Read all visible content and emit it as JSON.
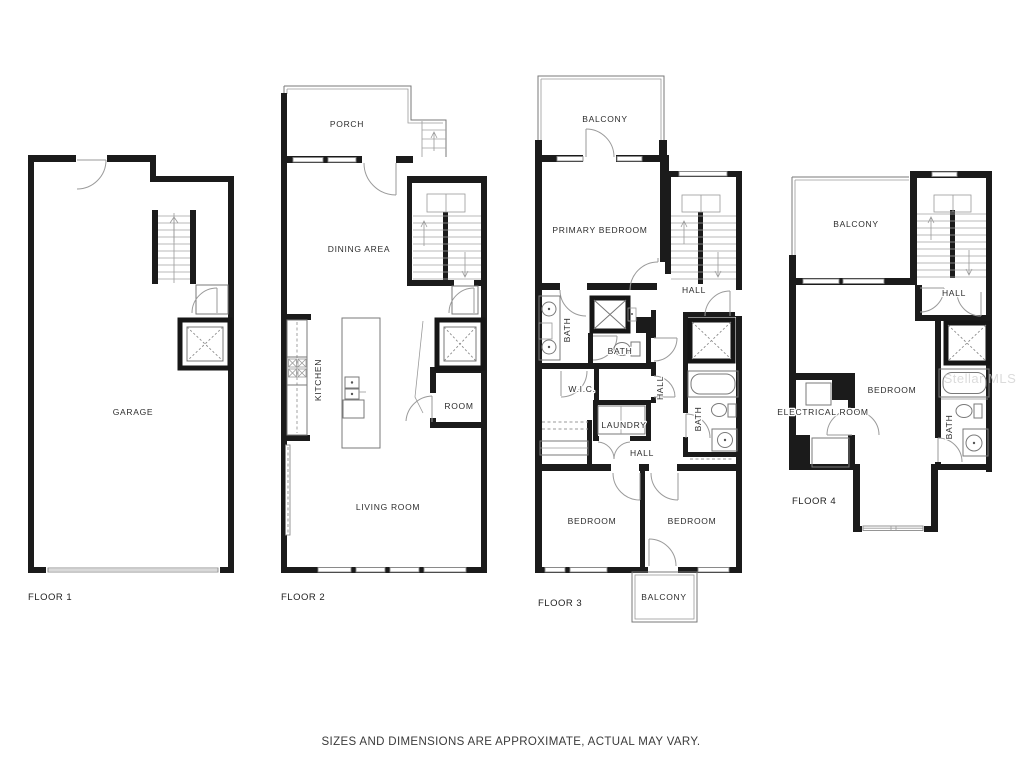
{
  "colors": {
    "background": "#ffffff",
    "wall": "#1b1b1b",
    "thin_line": "#7a7a7a",
    "label": "#2d2d2d",
    "watermark": "#c9c9c9"
  },
  "floor1": {
    "floor_label": "FLOOR 1",
    "rooms": {
      "garage": "GARAGE"
    }
  },
  "floor2": {
    "floor_label": "FLOOR 2",
    "rooms": {
      "porch": "PORCH",
      "dining_area": "DINING AREA",
      "kitchen": "KITCHEN",
      "room": "ROOM",
      "living_room": "LIVING ROOM"
    }
  },
  "floor3": {
    "floor_label": "FLOOR 3",
    "rooms": {
      "balcony_top": "BALCONY",
      "primary_bedroom": "PRIMARY BEDROOM",
      "hall_upper": "HALL",
      "primary_bath": "BATH",
      "water_closet": "BATH",
      "wic": "W.I.C.",
      "hall_mid": "HALL",
      "laundry": "LAUNDRY",
      "hall_lower": "HALL",
      "hall_bath": "BATH",
      "bedroom_left": "BEDROOM",
      "bedroom_right": "BEDROOM",
      "balcony_bottom": "BALCONY"
    }
  },
  "floor4": {
    "floor_label": "FLOOR 4",
    "rooms": {
      "balcony": "BALCONY",
      "hall": "HALL",
      "bedroom": "BEDROOM",
      "electrical_room": "ELECTRICAL ROOM",
      "bath": "BATH"
    }
  },
  "footer": {
    "disclaimer": "SIZES AND DIMENSIONS ARE APPROXIMATE, ACTUAL MAY VARY."
  },
  "watermark": {
    "text": "Stellar MLS"
  }
}
